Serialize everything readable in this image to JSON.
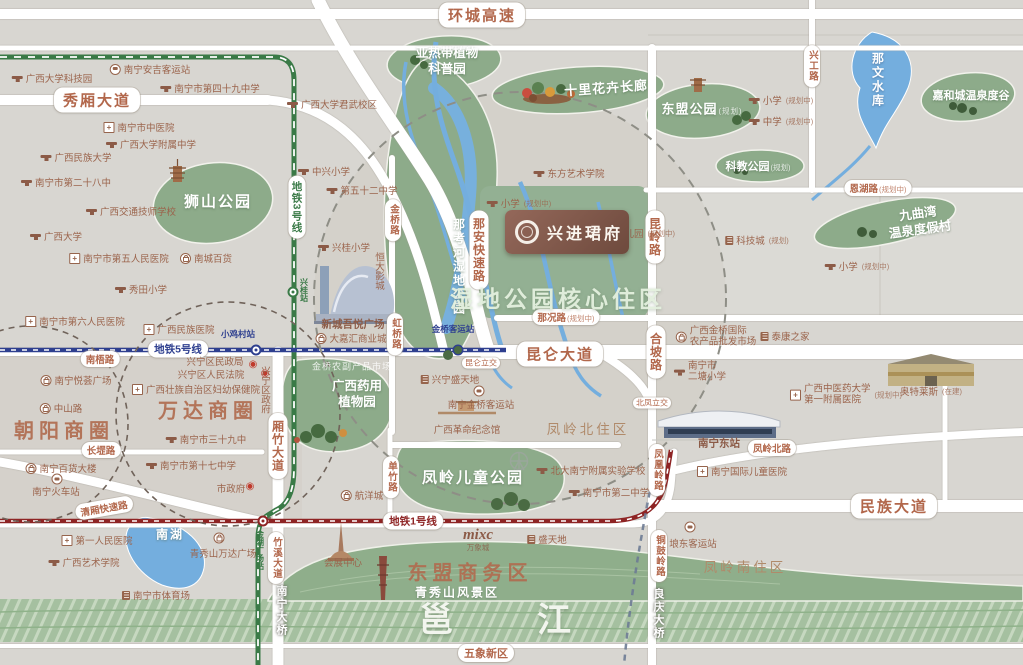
{
  "project": {
    "name": "兴进珺府"
  },
  "colors": {
    "background": "#d8d6d1",
    "road": "#ffffff",
    "road_text": "#b2674b",
    "park_green": "#8dab8a",
    "water_blue": "#74aede",
    "river_green": "#a5c0a0",
    "metro_line5": "#2e3f8f",
    "metro_line1": "#8e2424",
    "metro_line3": "#3a7a47",
    "district_text": "#b06b4f",
    "poi_text": "#9b644c",
    "plaque_brown": "#7d5445"
  },
  "metro_lines": [
    {
      "name": "地铁5号线",
      "color": "#2e3f8f"
    },
    {
      "name": "地铁1号线",
      "color": "#8e2424"
    },
    {
      "name": "地铁3号线",
      "color": "#3a7a47"
    }
  ],
  "labels": [
    {
      "n": "huancheng-expressway-label",
      "t": "环城高速",
      "k": "hwy",
      "x": 482,
      "y": 15
    },
    {
      "n": "xiuxiang-avenue-label",
      "t": "秀厢大道",
      "k": "hwy",
      "x": 97,
      "y": 100
    },
    {
      "n": "metro-line3-label",
      "t": "地铁3号线",
      "k": "metrov",
      "c": "#3a7a47",
      "x": 297,
      "y": 207
    },
    {
      "n": "metro-line5-label",
      "t": "地铁5号线",
      "k": "metroh",
      "c": "#2e3f8f",
      "x": 178,
      "y": 349
    },
    {
      "n": "nanwu-road-label",
      "t": "南梧路",
      "k": "roadsm",
      "x": 100,
      "y": 359
    },
    {
      "n": "kunlun-avenue-label",
      "t": "昆仑大道",
      "k": "hwy",
      "x": 560,
      "y": 354
    },
    {
      "n": "nakuang-road-label",
      "t": "那况路",
      "s": "(规划中)",
      "k": "roadsm",
      "x": 566,
      "y": 317
    },
    {
      "n": "enhu-road-label",
      "t": "恩湖路",
      "s": "(规划中)",
      "k": "roadsm",
      "x": 878,
      "y": 188
    },
    {
      "n": "xinggong-road-label",
      "t": "兴工路",
      "k": "roadvsm",
      "x": 812,
      "y": 66
    },
    {
      "n": "kunling-road-label",
      "t": "昆岭路",
      "k": "roadv",
      "x": 655,
      "y": 237
    },
    {
      "n": "hepo-road-label",
      "t": "合坡路",
      "k": "roadv",
      "x": 656,
      "y": 352
    },
    {
      "n": "fenghuangling-road-label",
      "t": "凤凰岭路",
      "k": "roadvsm",
      "x": 657,
      "y": 470
    },
    {
      "n": "tonguling-road-label",
      "t": "铜鼓岭路",
      "k": "roadvsm",
      "x": 659,
      "y": 556
    },
    {
      "n": "liangqing-bridge-label",
      "t": "良庆大桥",
      "k": "bridgev",
      "x": 658,
      "y": 614
    },
    {
      "n": "jinqiao-road-label",
      "t": "金桥路",
      "k": "roadvsm",
      "x": 393,
      "y": 220
    },
    {
      "n": "hongqiao-road-label",
      "t": "虹桥路",
      "k": "roadvsm",
      "x": 395,
      "y": 334
    },
    {
      "n": "naan-expressway-label",
      "t": "那安快速路",
      "k": "roadv",
      "x": 479,
      "y": 250
    },
    {
      "n": "xiangzhu-avenue-label",
      "t": "厢竹大道",
      "k": "roadv",
      "x": 278,
      "y": 446
    },
    {
      "n": "zhuxi-avenue-label",
      "t": "竹溪大道",
      "k": "roadvsm",
      "x": 276,
      "y": 558
    },
    {
      "n": "nanning-bridge-label",
      "t": "南宁大桥",
      "k": "bridgev",
      "x": 281,
      "y": 611
    },
    {
      "n": "danzhu-road-label",
      "t": "单竹路",
      "k": "roadvsm",
      "x": 391,
      "y": 477
    },
    {
      "n": "changgang-road-label",
      "t": "长堽路",
      "k": "roadsm",
      "x": 101,
      "y": 450
    },
    {
      "n": "qingxiang-expressway-label",
      "t": "清厢快速路",
      "k": "roadsm",
      "x": 104,
      "y": 508,
      "r": -10
    },
    {
      "n": "metro-line1-label",
      "t": "地铁1号线",
      "k": "metroh",
      "c": "#8e2424",
      "x": 413,
      "y": 521
    },
    {
      "n": "minzu-avenue-label",
      "t": "民族大道",
      "k": "hwy",
      "x": 894,
      "y": 506
    },
    {
      "n": "fengling-north-road-label",
      "t": "凤岭北路",
      "k": "roadsm",
      "x": 772,
      "y": 448
    },
    {
      "n": "kunlun-interchange-label",
      "t": "昆仑立交",
      "k": "tiny",
      "x": 481,
      "y": 363
    },
    {
      "n": "beifeng-interchange-label",
      "t": "北凤立交",
      "k": "tiny",
      "x": 652,
      "y": 403
    },
    {
      "n": "wuxiang-district-label",
      "t": "五象新区",
      "k": "road",
      "x": 486,
      "y": 653
    },
    {
      "n": "shishan-park-label",
      "t": "狮山公园",
      "k": "parkxl",
      "x": 218,
      "y": 201
    },
    {
      "n": "subtropical-garden-label",
      "t": "亚热带植物\n科普园",
      "k": "park2",
      "x": 447,
      "y": 61
    },
    {
      "n": "flower-corridor-label",
      "t": "十里花卉长廊",
      "k": "park",
      "x": 606,
      "y": 87,
      "r": -4
    },
    {
      "n": "asean-park-label",
      "t": "东盟公园",
      "s": "(规划)",
      "k": "park",
      "x": 702,
      "y": 108
    },
    {
      "n": "kejiao-park-label",
      "t": "科教公园",
      "s": "(规划)",
      "k": "parksm",
      "x": 758,
      "y": 166
    },
    {
      "n": "jiahecheng-springs-label",
      "t": "嘉和城温泉度谷",
      "k": "parksm",
      "x": 971,
      "y": 95
    },
    {
      "n": "nawen-reservoir-label",
      "t": "那文水库",
      "k": "waterv",
      "x": 878,
      "y": 80
    },
    {
      "n": "jiuquwan-resort-label",
      "t": "九曲湾\n温泉度假村",
      "k": "park2",
      "x": 919,
      "y": 222,
      "r": -8
    },
    {
      "n": "nakao-wetland-park-label",
      "t": "那考河湿地公园",
      "k": "parkv",
      "x": 459,
      "y": 267
    },
    {
      "n": "wetland-core-zone-label",
      "t": "湿地公园核心住区",
      "k": "zone",
      "x": 558,
      "y": 297
    },
    {
      "n": "medicinal-garden-label",
      "t": "广西药用\n植物园",
      "k": "park2",
      "x": 357,
      "y": 394
    },
    {
      "n": "fengling-children-park-label",
      "t": "凤岭儿童公园",
      "k": "parkxl",
      "x": 473,
      "y": 477
    },
    {
      "n": "nanhu-lake-label",
      "t": "南湖",
      "k": "white",
      "x": 170,
      "y": 534
    },
    {
      "n": "qingxiushan-label",
      "t": "青秀山风景区",
      "k": "white",
      "x": 457,
      "y": 592
    },
    {
      "n": "yongjiang-char-1",
      "t": "邕",
      "k": "riverchar",
      "x": 436,
      "y": 617
    },
    {
      "n": "yongjiang-char-2",
      "t": "江",
      "k": "riverchar",
      "x": 554,
      "y": 617
    },
    {
      "n": "chaoyang-circle-label",
      "t": "朝阳商圈",
      "k": "district",
      "x": 64,
      "y": 429
    },
    {
      "n": "wanda-circle-label",
      "t": "万达商圈",
      "k": "district",
      "x": 208,
      "y": 409
    },
    {
      "n": "asean-business-district-label",
      "t": "东盟商务区",
      "k": "district",
      "x": 470,
      "y": 571
    },
    {
      "n": "fengling-north-zone-label",
      "t": "凤岭北住区",
      "k": "area",
      "x": 588,
      "y": 428
    },
    {
      "n": "fengling-south-zone-label",
      "t": "凤岭南住区",
      "k": "area",
      "x": 745,
      "y": 566
    },
    {
      "n": "poi-gxu-science-park",
      "t": "广西大学科技园",
      "k": "poi",
      "i": "school",
      "x": 52,
      "y": 78
    },
    {
      "n": "poi-anji-bus-station",
      "t": "南宁安吉客运站",
      "k": "poi",
      "i": "bus",
      "x": 150,
      "y": 69
    },
    {
      "n": "poi-no49-middle-school",
      "t": "南宁市第四十九中学",
      "k": "poi",
      "i": "school",
      "x": 210,
      "y": 88
    },
    {
      "n": "poi-gxu-junwu-campus",
      "t": "广西大学君武校区",
      "k": "poi",
      "i": "school",
      "x": 332,
      "y": 104
    },
    {
      "n": "poi-tcm-hospital",
      "t": "南宁市中医院",
      "k": "poi",
      "i": "hosp",
      "x": 139,
      "y": 127
    },
    {
      "n": "poi-gxu-affiliated-school",
      "t": "广西大学附属中学",
      "k": "poi",
      "i": "school",
      "x": 151,
      "y": 144
    },
    {
      "n": "poi-minzu-university",
      "t": "广西民族大学",
      "k": "poi",
      "i": "school",
      "x": 76,
      "y": 157
    },
    {
      "n": "poi-no28-middle-school",
      "t": "南宁市第二十八中",
      "k": "poi",
      "i": "school",
      "x": 66,
      "y": 182
    },
    {
      "n": "poi-jiaotong-school",
      "t": "广西交通技师学校",
      "k": "poi",
      "i": "school",
      "x": 131,
      "y": 211
    },
    {
      "n": "poi-guangxi-university",
      "t": "广西大学",
      "k": "poi",
      "i": "school",
      "x": 56,
      "y": 236
    },
    {
      "n": "poi-no5-hospital",
      "t": "南宁市第五人民医院",
      "k": "poi",
      "i": "hosp",
      "x": 119,
      "y": 258
    },
    {
      "n": "poi-nancheng-store",
      "t": "南城百货",
      "k": "poi",
      "i": "shop",
      "x": 206,
      "y": 258
    },
    {
      "n": "poi-xiutian-primary",
      "t": "秀田小学",
      "k": "poi",
      "i": "school",
      "x": 141,
      "y": 289
    },
    {
      "n": "poi-no6-hospital",
      "t": "南宁市第六人民医院",
      "k": "poi",
      "i": "hosp",
      "x": 75,
      "y": 321
    },
    {
      "n": "poi-minzu-hospital",
      "t": "广西民族医院",
      "k": "poi",
      "i": "hosp",
      "x": 179,
      "y": 329
    },
    {
      "n": "xiaojicun-station-label",
      "t": "小鸡村站",
      "k": "stn",
      "c": "#2e3f8f",
      "x": 238,
      "y": 334
    },
    {
      "n": "poi-zhongxing-primary",
      "t": "中兴小学",
      "k": "poi",
      "i": "school",
      "x": 324,
      "y": 171
    },
    {
      "n": "poi-no52-middle-school",
      "t": "第五十二中学",
      "k": "poi",
      "i": "school",
      "x": 362,
      "y": 190
    },
    {
      "n": "poi-xinggui-primary",
      "t": "兴桂小学",
      "k": "poi",
      "i": "school",
      "x": 344,
      "y": 247
    },
    {
      "n": "poi-hengda-cinema",
      "t": "恒大影城",
      "k": "poiv",
      "x": 378,
      "y": 271
    },
    {
      "n": "xinggui-station-label",
      "t": "兴桂站",
      "k": "stnv",
      "c": "#3a7a47",
      "x": 304,
      "y": 290
    },
    {
      "n": "poi-wuyue-plaza",
      "t": "新城吾悦广场",
      "k": "poibold",
      "x": 353,
      "y": 324
    },
    {
      "n": "poi-dajiahui-mall",
      "t": "大嘉汇商业城",
      "k": "poi",
      "i": "shop",
      "x": 351,
      "y": 338
    },
    {
      "n": "poi-dongfang-art-college",
      "t": "东方艺术学院",
      "k": "poi",
      "i": "school",
      "x": 569,
      "y": 173
    },
    {
      "n": "poi-primary-planned-1",
      "t": "小学",
      "s": "(规划中)",
      "k": "poi",
      "i": "school",
      "x": 519,
      "y": 203
    },
    {
      "n": "poi-kindergarten-planned",
      "t": "幼儿园",
      "s": "(规划中)",
      "k": "poi",
      "i": "school",
      "x": 638,
      "y": 233
    },
    {
      "n": "poi-primary-planned-2",
      "t": "小学",
      "s": "(规划中)",
      "k": "poi",
      "i": "school",
      "x": 857,
      "y": 266
    },
    {
      "n": "poi-tech-city",
      "t": "科技城",
      "s": "(规划)",
      "k": "poi",
      "i": "build",
      "x": 757,
      "y": 240
    },
    {
      "n": "poi-primary-planned-3",
      "t": "小学",
      "s": "(规划中)",
      "k": "poi",
      "i": "school",
      "x": 781,
      "y": 100
    },
    {
      "n": "poi-middle-planned",
      "t": "中学",
      "s": "(规划中)",
      "k": "poi",
      "i": "school",
      "x": 781,
      "y": 121
    },
    {
      "n": "jinqiao-station-label",
      "t": "金桥客运站",
      "k": "stn",
      "c": "#2e3f8f",
      "x": 453,
      "y": 329
    },
    {
      "n": "poi-jinqiao-farm-market",
      "t": "金桥农副产品市场",
      "k": "ghost",
      "x": 352,
      "y": 366
    },
    {
      "n": "poi-xingning-shengtiandi",
      "t": "兴宁盛天地",
      "k": "poi",
      "i": "build",
      "x": 450,
      "y": 379
    },
    {
      "n": "jinqiao-bus-icon",
      "k": "icon",
      "i": "bus",
      "x": 479,
      "y": 391
    },
    {
      "n": "poi-jinqiao-bus-station",
      "t": "南宁金桥客运站",
      "k": "poi",
      "x": 481,
      "y": 404
    },
    {
      "n": "poi-revolution-memorial",
      "t": "广西革命纪念馆",
      "k": "poi",
      "x": 467,
      "y": 429
    },
    {
      "n": "poi-pku-experimental-school",
      "t": "北大南宁附属实验学校",
      "k": "poi",
      "i": "school",
      "x": 591,
      "y": 470
    },
    {
      "n": "poi-no2-middle-school",
      "t": "南宁市第二中学",
      "k": "poi",
      "i": "school",
      "x": 609,
      "y": 492
    },
    {
      "n": "poi-jinqiao-wholesale-market",
      "t": "广西金桥国际\n农产品批发市场",
      "k": "poi2",
      "i": "shop",
      "x": 716,
      "y": 337
    },
    {
      "n": "poi-taikang-home",
      "t": "泰康之家",
      "k": "poi",
      "i": "build",
      "x": 785,
      "y": 336
    },
    {
      "n": "poi-ertang-primary",
      "t": "南宁市\n二塘小学",
      "k": "poi2",
      "i": "school",
      "x": 700,
      "y": 372
    },
    {
      "n": "poi-tcm-first-affiliated-hospital",
      "t": "广西中医药大学\n第一附属医院",
      "s": "(规划中)",
      "k": "poi2",
      "i": "hosp",
      "x": 846,
      "y": 395
    },
    {
      "n": "poi-outlets",
      "t": "奥特莱斯",
      "s": "(在建)",
      "k": "poi",
      "x": 931,
      "y": 391
    },
    {
      "n": "poi-nanning-east-station",
      "t": "南宁东站",
      "k": "poibold",
      "x": 719,
      "y": 443
    },
    {
      "n": "poi-intl-children-hospital",
      "t": "南宁国际儿童医院",
      "k": "poi",
      "i": "hosp",
      "x": 742,
      "y": 471
    },
    {
      "n": "langdong-bus-icon",
      "k": "icon",
      "i": "bus",
      "x": 690,
      "y": 527
    },
    {
      "n": "poi-langdong-bus-station",
      "t": "埌东客运站",
      "k": "poi",
      "x": 693,
      "y": 543
    },
    {
      "n": "poi-xingning-civil-affairs",
      "t": "兴宁区民政局",
      "k": "poi",
      "x": 215,
      "y": 361
    },
    {
      "n": "poi-xingning-court",
      "t": "兴宁区人民法院",
      "k": "poi",
      "x": 211,
      "y": 374
    },
    {
      "n": "target-icon-1",
      "k": "icon",
      "i": "target",
      "x": 253,
      "y": 365
    },
    {
      "n": "target-icon-2",
      "k": "icon",
      "i": "target",
      "x": 265,
      "y": 374
    },
    {
      "n": "poi-maternal-health-hospital",
      "t": "广西壮族自治区妇幼保健院",
      "k": "poi",
      "i": "hosp",
      "x": 196,
      "y": 389
    },
    {
      "n": "poi-xingning-government",
      "t": "兴宁区政府",
      "k": "poiv",
      "x": 264,
      "y": 390
    },
    {
      "n": "poi-no39-middle-school",
      "t": "南宁市三十九中",
      "k": "poi",
      "i": "school",
      "x": 206,
      "y": 439
    },
    {
      "n": "poi-no17-middle-school",
      "t": "南宁市第十七中学",
      "k": "poi",
      "i": "school",
      "x": 191,
      "y": 465
    },
    {
      "n": "poi-city-government",
      "t": "市政府",
      "k": "poi",
      "x": 231,
      "y": 488
    },
    {
      "n": "target-icon-3",
      "k": "icon",
      "i": "target",
      "x": 250,
      "y": 487
    },
    {
      "n": "poi-zhongshan-road",
      "t": "中山路",
      "k": "poi",
      "i": "shop",
      "x": 61,
      "y": 408
    },
    {
      "n": "poi-yuehui-plaza",
      "t": "南宁悦荟广场",
      "k": "poi",
      "i": "shop",
      "x": 76,
      "y": 380
    },
    {
      "n": "poi-department-store",
      "t": "南宁百货大楼",
      "k": "poi",
      "i": "shop",
      "x": 61,
      "y": 468
    },
    {
      "n": "railway-station-icon",
      "k": "icon",
      "i": "bus",
      "x": 57,
      "y": 479
    },
    {
      "n": "poi-nanning-railway-station",
      "t": "南宁火车站",
      "k": "poi",
      "x": 56,
      "y": 491
    },
    {
      "n": "poi-first-people-hospital",
      "t": "第一人民医院",
      "k": "poi",
      "i": "hosp",
      "x": 97,
      "y": 540
    },
    {
      "n": "poi-guangxi-arts-college",
      "t": "广西艺术学院",
      "k": "poi",
      "i": "school",
      "x": 84,
      "y": 562
    },
    {
      "n": "poi-nanning-stadium",
      "t": "南宁市体育场",
      "k": "poi",
      "i": "build",
      "x": 156,
      "y": 595
    },
    {
      "n": "qingxiushan-wanda-icon",
      "k": "icon",
      "i": "shop",
      "x": 219,
      "y": 538
    },
    {
      "n": "poi-qingxiushan-wanda",
      "t": "青秀山万达广场",
      "k": "poi",
      "x": 223,
      "y": 553
    },
    {
      "n": "poi-hangyang-city",
      "t": "航洋城",
      "k": "poi",
      "i": "shop",
      "x": 362,
      "y": 495
    },
    {
      "n": "poi-convention-center",
      "t": "会展中心",
      "k": "poi",
      "x": 343,
      "y": 562
    },
    {
      "n": "poi-mixc",
      "t": "mixc",
      "s": "万象城",
      "k": "mixc",
      "x": 478,
      "y": 540
    },
    {
      "n": "poi-shengtiandi",
      "t": "盛天地",
      "k": "poi",
      "i": "build",
      "x": 547,
      "y": 539
    },
    {
      "n": "jinhu-square-station-label",
      "t": "金湖广场站",
      "k": "stnv",
      "c": "#3a7a47",
      "x": 260,
      "y": 550
    }
  ]
}
